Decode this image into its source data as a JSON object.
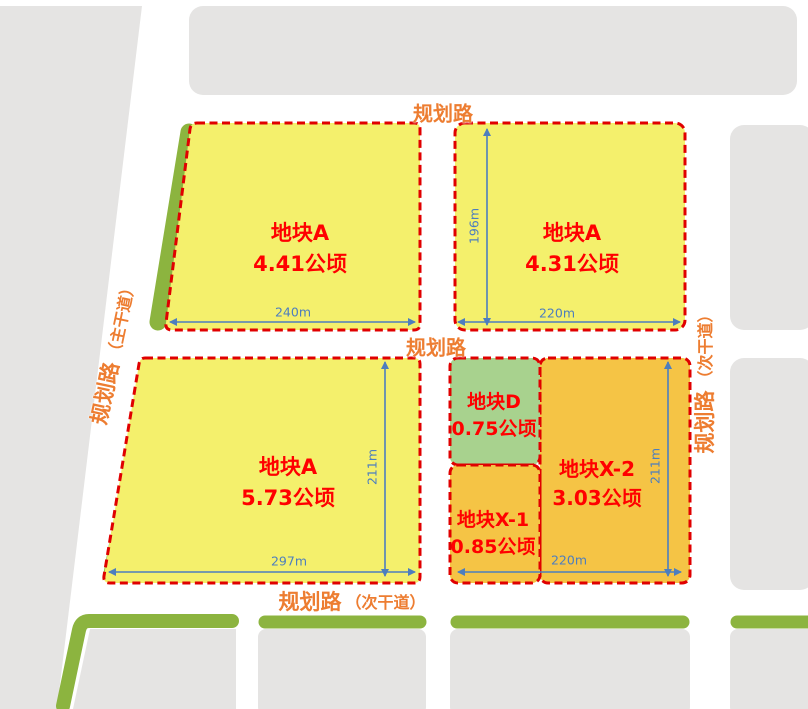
{
  "plan": {
    "parcels": [
      {
        "name": "地块A",
        "area": "4.41公顷"
      },
      {
        "name": "地块A",
        "area": "4.31公顷"
      },
      {
        "name": "地块A",
        "area": "5.73公顷"
      },
      {
        "name": "地块D",
        "area": "0.75公顷"
      },
      {
        "name": "地块X-1",
        "area": "0.85公顷"
      },
      {
        "name": "地块X-2",
        "area": "3.03公顷"
      }
    ],
    "road_labels": {
      "top": "规划路",
      "middle": "规划路",
      "bottom_name": "规划路",
      "bottom_type": "（次干道）",
      "left_name": "规划路",
      "left_type": "（主干道）",
      "right_name": "规划路",
      "right_type": "（次干道）"
    },
    "dimensions": {
      "a1_width": "240m",
      "a2_height": "196m",
      "a2_width": "220m",
      "a3_height": "211m",
      "a3_width": "297m",
      "x2_height": "211m",
      "x_block_width": "220m"
    },
    "colors": {
      "parcel_yellow": "#F4F06C",
      "parcel_orange": "#F5C445",
      "parcel_green": "#A8D28E",
      "greenbelt_green": "#8CB43F",
      "block_gray": "#E5E4E3",
      "boundary_red": "#E00000",
      "parcel_label_red": "#FF0000",
      "road_label_orange": "#ED7D31",
      "dimension_blue": "#4D7EBE"
    }
  }
}
